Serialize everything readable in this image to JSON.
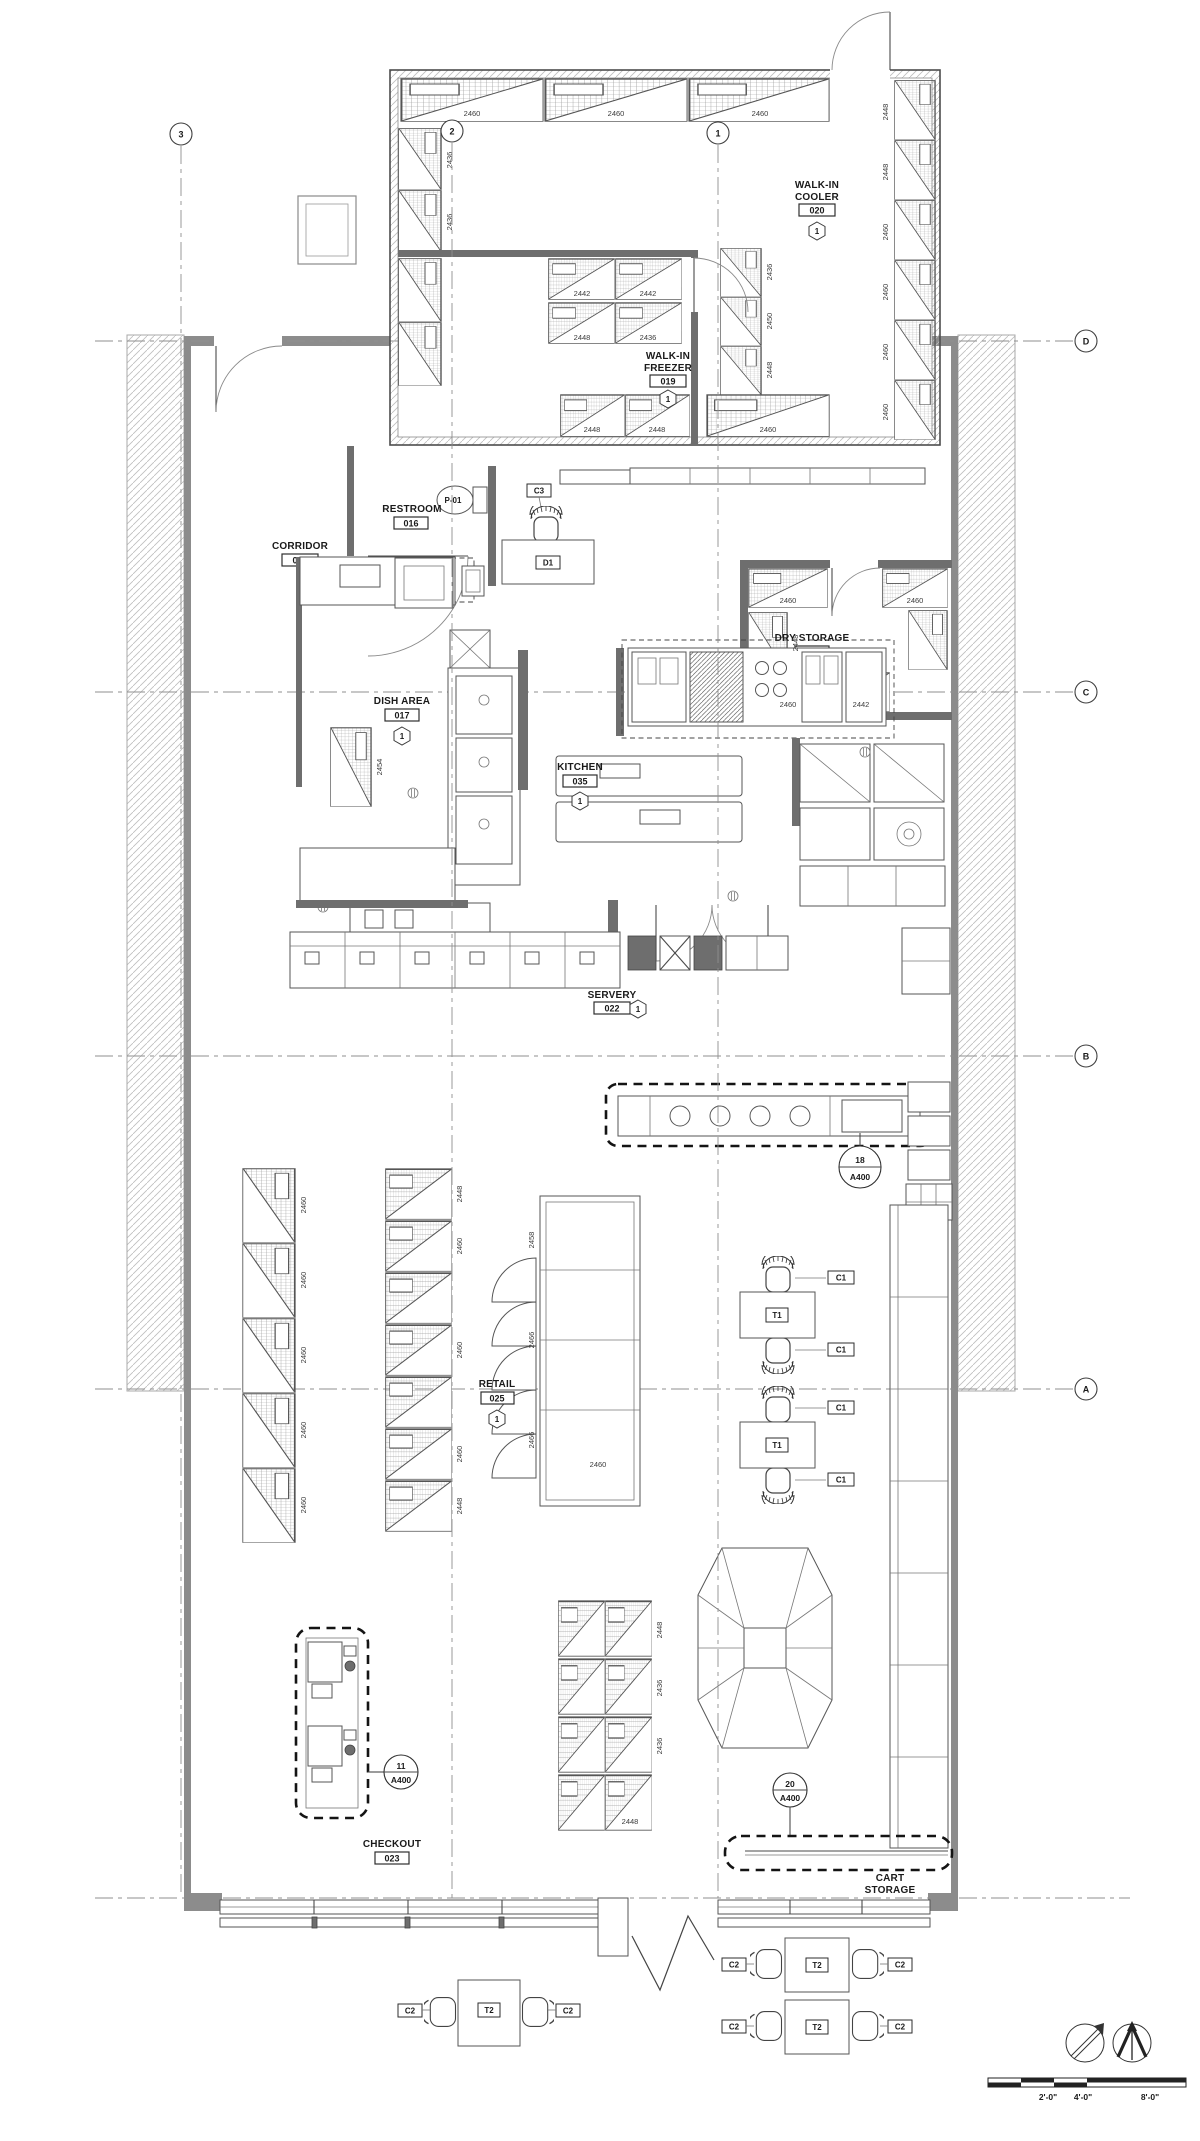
{
  "drawing": {
    "grid": {
      "cols": [
        "3",
        "2",
        "1"
      ],
      "rows": [
        "D",
        "C",
        "B",
        "A"
      ]
    },
    "rooms": {
      "walk_in_cooler": {
        "name": [
          "WALK-IN",
          "COOLER"
        ],
        "number": "020",
        "finish_tag": "1"
      },
      "walk_in_freezer": {
        "name": [
          "WALK-IN",
          "FREEZER"
        ],
        "number": "019",
        "finish_tag": "1"
      },
      "restroom": {
        "name": "RESTROOM",
        "number": "016"
      },
      "corridor": {
        "name": "CORRIDOR",
        "number": "024"
      },
      "dry_storage": {
        "name": "DRY STORAGE",
        "number": "034",
        "finish_tag": "1"
      },
      "dish_area": {
        "name": "DISH AREA",
        "number": "017",
        "finish_tag": "1"
      },
      "kitchen": {
        "name": "KITCHEN",
        "number": "035",
        "finish_tag": "1"
      },
      "servery": {
        "name": "SERVERY",
        "number": "022",
        "finish_tag": "1"
      },
      "retail": {
        "name": "RETAIL",
        "number": "025",
        "finish_tag": "1"
      },
      "checkout": {
        "name": "CHECKOUT",
        "number": "023"
      },
      "cart_storage": {
        "name": [
          "CART",
          "STORAGE"
        ]
      }
    },
    "fixture_tags": {
      "toilet": "P-01",
      "mop_sink": "P-02",
      "office_chair": "C3",
      "desk": "D1",
      "dining_table": "T1",
      "dining_chair": "C1",
      "outdoor_table": "T2",
      "outdoor_chair": "C2"
    },
    "callouts": {
      "servery_counter": {
        "detail": "18",
        "sheet": "A400"
      },
      "checkout_counter": {
        "detail": "11",
        "sheet": "A400"
      },
      "cart_rail": {
        "detail": "20",
        "sheet": "A400"
      }
    },
    "scale_bar": {
      "labels": [
        "2'-0\"",
        "4'-0\"",
        "8'-0\""
      ]
    },
    "dims": [
      "2460",
      "2460",
      "2460",
      "2448",
      "2448",
      "2460",
      "2460",
      "2460",
      "2460",
      "2436",
      "2436",
      "2442",
      "2442",
      "2448",
      "2436",
      "2448",
      "2448",
      "2460",
      "2436",
      "2450",
      "2448",
      "2460",
      "2448",
      "2460",
      "2442",
      "2460",
      "2454",
      "2460",
      "2460",
      "2460",
      "2460",
      "2460",
      "2448",
      "2460",
      "2460",
      "2460",
      "2448",
      "2458",
      "2466",
      "2466",
      "2460",
      "2448",
      "2436",
      "2436",
      "2448"
    ]
  }
}
